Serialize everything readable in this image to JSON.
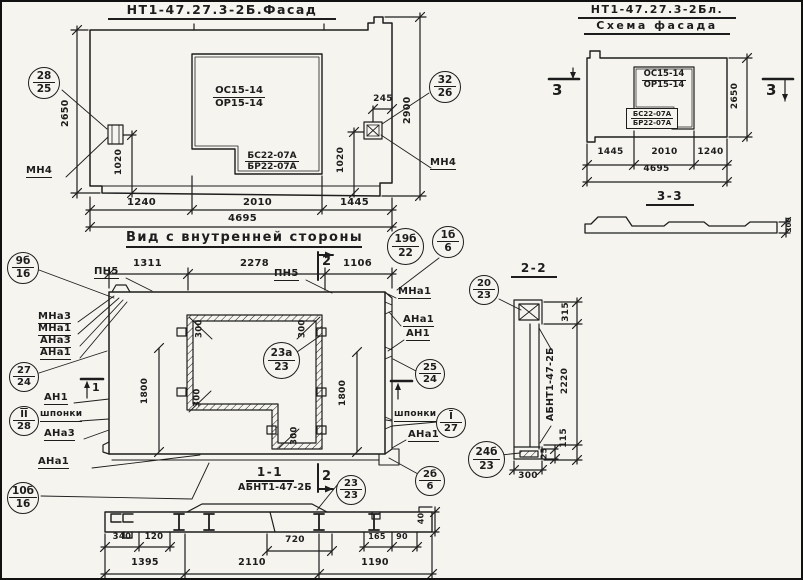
{
  "colors": {
    "paper": "#f5f4ef",
    "ink": "#1d1d1d"
  },
  "facade": {
    "title": "НТ1-47.27.3-2Б.Фасад",
    "window_mark_top": "ОС15-14",
    "window_mark_bottom": "ОР15-14",
    "sill_mark_top": "БС22-07А",
    "sill_mark_bottom": "БР22-07А",
    "dim_height_left": "2650",
    "dim_height_right": "2900",
    "dim_notch": "245",
    "dim_anchor_left": "1020",
    "dim_anchor_right": "1020",
    "dim_seg1": "1240",
    "dim_seg2": "2010",
    "dim_seg3": "1445",
    "dim_total": "4695",
    "callout_left": {
      "top": "28",
      "bottom": "25"
    },
    "callout_right": {
      "top": "32",
      "bottom": "26"
    },
    "anchor_mark_left": "МН4",
    "anchor_mark_right": "МН4"
  },
  "schema": {
    "title_line1": "НТ1-47.27.3-2Бл.",
    "title_line2": "Схема фасада",
    "window_mark_top": "ОС15-14",
    "window_mark_bottom": "ОР15-14",
    "sill_mark_top": "БС22-07А",
    "sill_mark_bottom": "БР22-07А",
    "dim_height": "2650",
    "dim_seg1": "1445",
    "dim_seg2": "2010",
    "dim_seg3": "1240",
    "dim_total": "4695",
    "section_mark": "3",
    "section_title": "3-3",
    "section_depth": "300"
  },
  "inner": {
    "title": "Вид с внутренней стороны",
    "callout_19b": {
      "top": "19б",
      "bottom": "22"
    },
    "callout_1b": {
      "top": "1б",
      "bottom": "6"
    },
    "dim_seg1": "1311",
    "dim_seg2": "2278",
    "dim_seg3": "1106",
    "joint_left": "ПН5",
    "joint_right": "ПН5",
    "section_mark_2": "2",
    "section_mark_1": "1",
    "left_labels": [
      "МНа3",
      "МНа1",
      "АНа3",
      "АНа1"
    ],
    "right_labels": [
      "МНа1",
      "АНа1",
      "АН1"
    ],
    "callout_27": {
      "top": "27",
      "bottom": "24"
    },
    "an1_label": "АН1",
    "callout_II": {
      "top": "II",
      "bottom": "28"
    },
    "keys_left": "шпонки",
    "keys_right": "шпонки",
    "ana3_lower": "АНа3",
    "ana1_lower": "АНа1",
    "callout_10b": {
      "top": "10б",
      "bottom": "16"
    },
    "callout_9b": {
      "top": "9б",
      "bottom": "16"
    },
    "callout_25": {
      "top": "25",
      "bottom": "24"
    },
    "callout_I": {
      "top": "I",
      "bottom": "27"
    },
    "ana1_right_lower": "АНа1",
    "callout_2b": {
      "top": "2б",
      "bottom": "6"
    },
    "callout_23a": {
      "top": "23а",
      "bottom": "23"
    },
    "callout_23": {
      "top": "23",
      "bottom": "23"
    },
    "dim_height_left": "1800",
    "dim_height_right": "1800",
    "dim_corner": "300"
  },
  "section11": {
    "title": "1-1",
    "subtitle": "АБНТ1-47-2Б",
    "section_mark": "2",
    "dim_340": "340",
    "dim_120": "120",
    "dim_720": "720",
    "dim_165": "165",
    "dim_90": "90",
    "dim_40": "40",
    "dim_1395": "1395",
    "dim_2110": "2110",
    "dim_1190": "1190"
  },
  "section22": {
    "title": "2-2",
    "member_mark": "АБНТ1-47-2Б",
    "callout_20": {
      "top": "20",
      "bottom": "23"
    },
    "callout_24b": {
      "top": "24б",
      "bottom": "23"
    },
    "dim_315": "315",
    "dim_2220": "2220",
    "dim_115": "115",
    "dim_25": "25",
    "dim_300": "300"
  }
}
